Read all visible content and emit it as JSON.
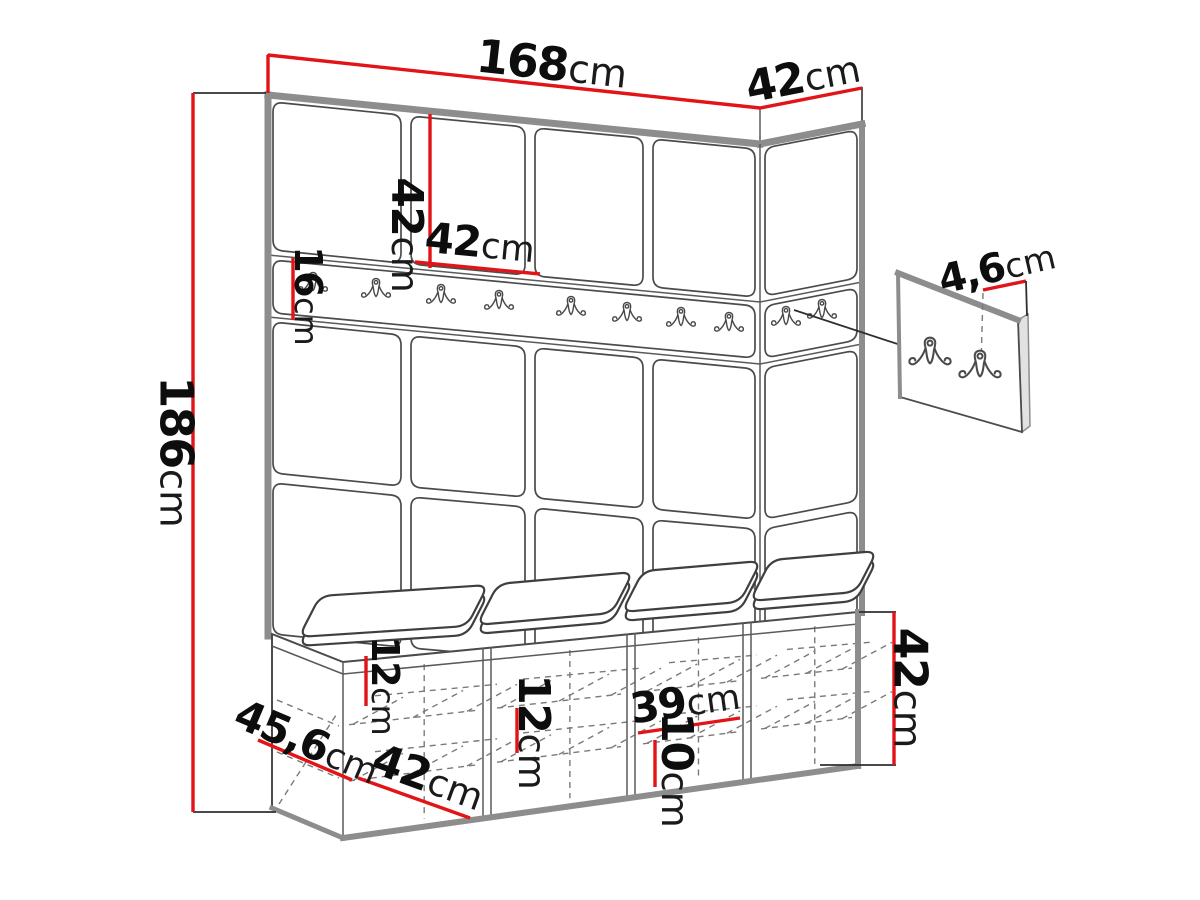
{
  "figure": {
    "type": "technical-drawing",
    "subject": "Hallway wardrobe wall-panel set with coat-hook rail, wall hook panel detail and shoe bench with seat cushions"
  },
  "dims": {
    "total_width": {
      "value": "168",
      "unit": "cm"
    },
    "side_depth": {
      "value": "42",
      "unit": "cm"
    },
    "total_height": {
      "value": "186",
      "unit": "cm"
    },
    "panel_height": {
      "value": "42",
      "unit": "cm"
    },
    "panel_width": {
      "value": "42",
      "unit": "cm"
    },
    "rail_height": {
      "value": "16",
      "unit": "cm"
    },
    "hook_offset": {
      "value": "4,6",
      "unit": "cm"
    },
    "bench_height": {
      "value": "42",
      "unit": "cm"
    },
    "bench_front_a": {
      "value": "12",
      "unit": "cm"
    },
    "bench_front_b": {
      "value": "12",
      "unit": "cm"
    },
    "bench_inner_width": {
      "value": "39",
      "unit": "cm"
    },
    "bench_inner_height": {
      "value": "10",
      "unit": "cm"
    },
    "bench_depth": {
      "value": "45,6",
      "unit": "cm"
    },
    "bench_section_width": {
      "value": "42",
      "unit": "cm"
    }
  },
  "counts": {
    "panel_columns": 4,
    "panel_rows": 3,
    "rail_hooks_front": 8,
    "rail_hooks_side": 2,
    "detail_panel_hooks": 2,
    "bench_sections": 4,
    "seat_cushions": 4
  },
  "colors": {
    "dimension": "#e21417",
    "outline": "#4b4b4b",
    "edge": "#8d8d8d",
    "background": "#ffffff"
  }
}
